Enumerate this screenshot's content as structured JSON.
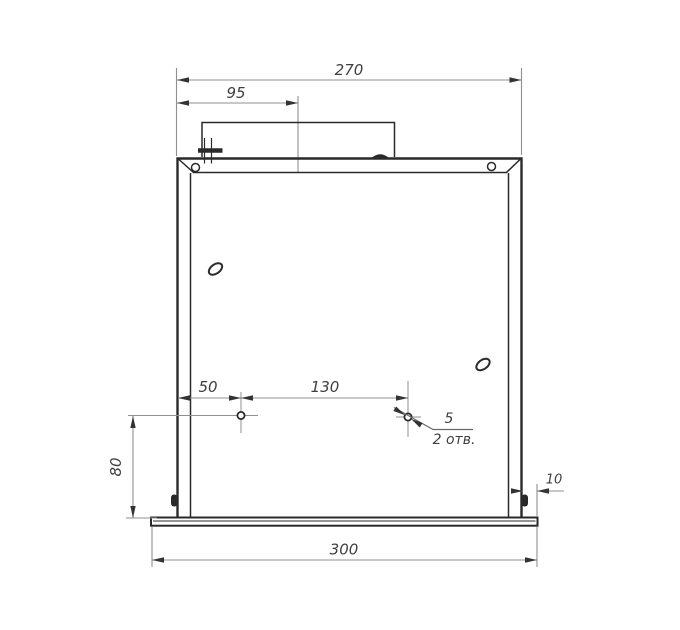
{
  "drawing": {
    "type": "engineering-drawing",
    "labels": {
      "overall_width": "270",
      "lid_offset": "95",
      "hole_left_offset": "50",
      "hole_spacing": "130",
      "hole_bottom_offset": "80",
      "flange_lip": "10",
      "base_width": "300",
      "hole_diameter": "5",
      "holes_note": "2 отв."
    },
    "colors": {
      "line": "#2a2a2a",
      "dimension": "#8f8f8f",
      "text": "#3f3f3f",
      "background": "#ffffff"
    }
  }
}
